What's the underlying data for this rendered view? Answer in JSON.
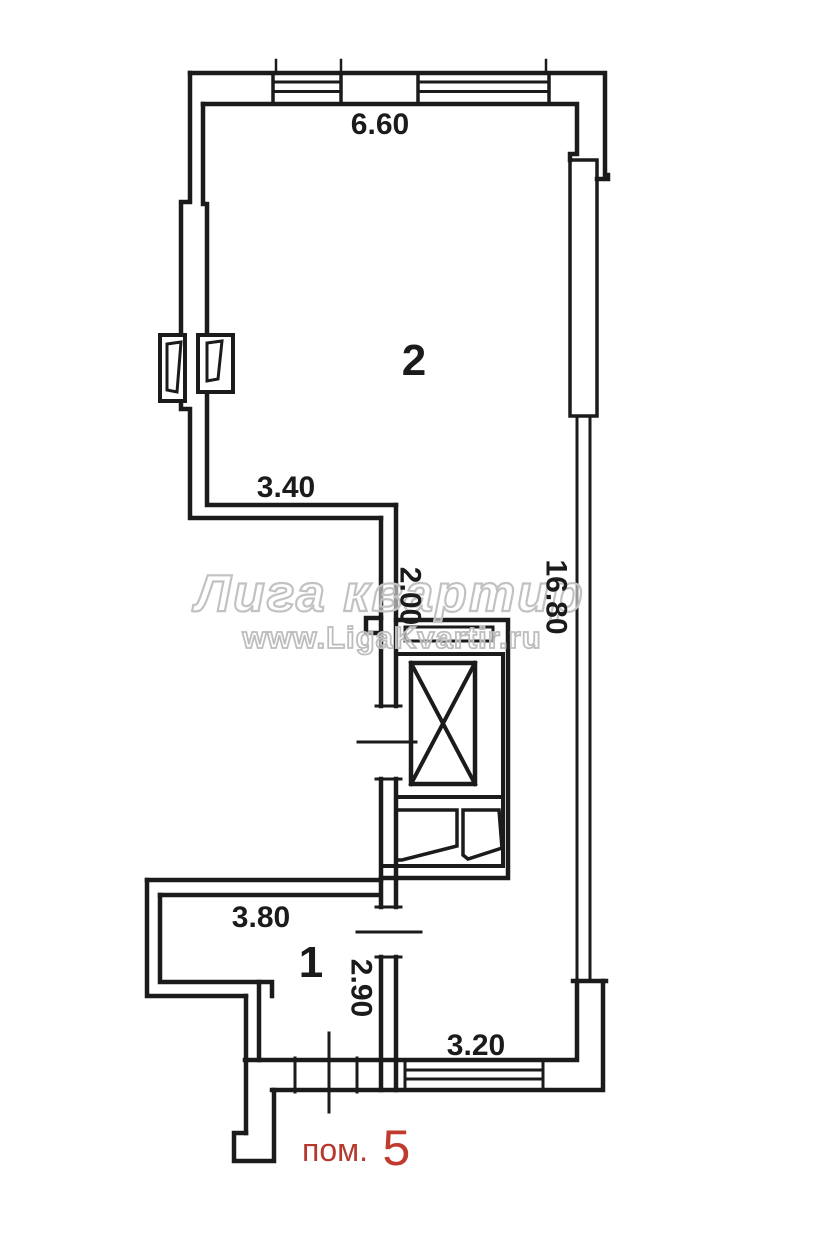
{
  "meta": {
    "background": "#ffffff",
    "line_color": "#1b1b1b",
    "accent_red": "#b6392e",
    "watermark_gray": "#c2c2c2"
  },
  "watermark": {
    "title": "Лига квартир",
    "url": "www.LigaKvartir.ru"
  },
  "rooms": {
    "room2": {
      "label": "2"
    },
    "room1": {
      "label": "1"
    }
  },
  "dimensions": {
    "top_width": "6.60",
    "room2_left_width": "3.40",
    "corridor_width": "2.00",
    "right_height": "16.80",
    "room1_width": "3.80",
    "room1_depth": "2.90",
    "bottom_window_width": "3.20"
  },
  "footer": {
    "prefix": "пом.",
    "number": "5"
  }
}
